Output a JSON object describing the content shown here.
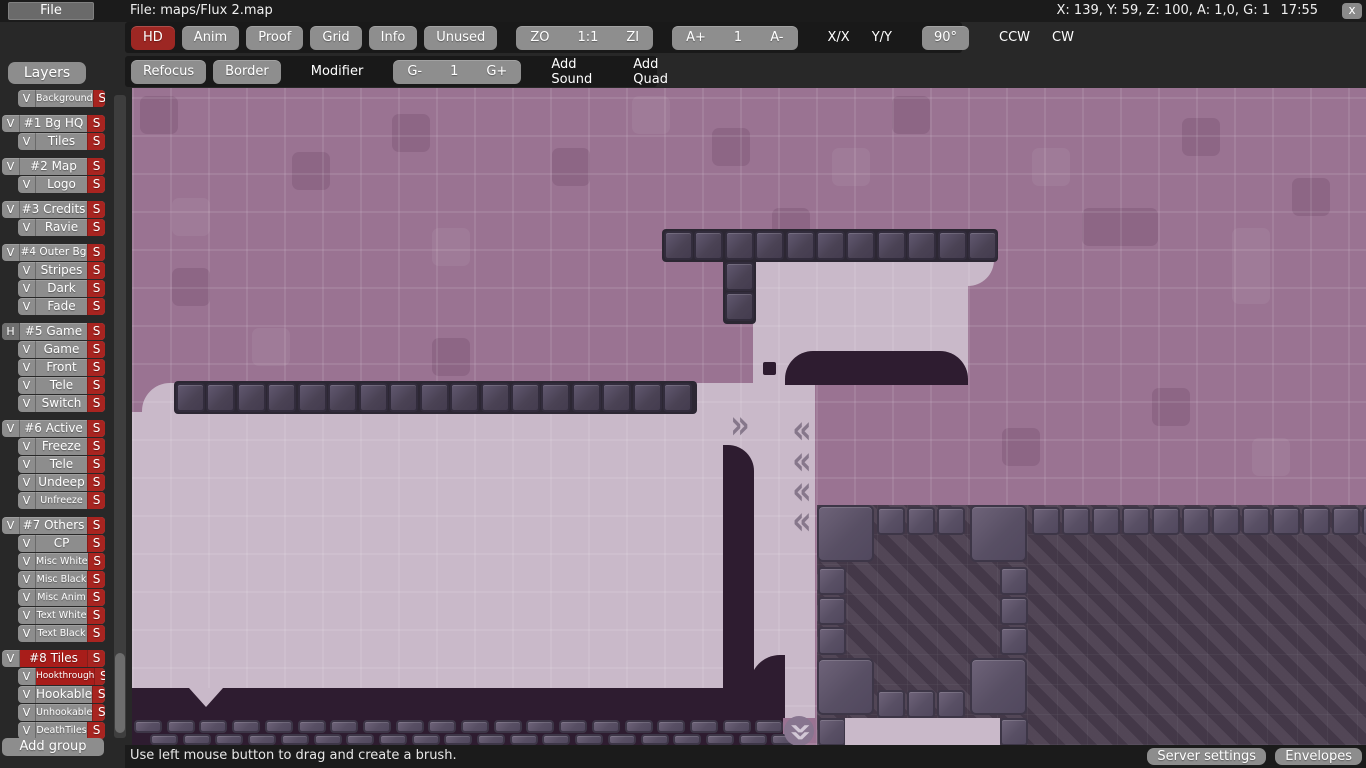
{
  "topbar": {
    "file_menu": "File",
    "title": "File: maps/Flux 2.map",
    "info": "X: 139, Y: 59, Z: 100, A: 1,0, G: 1",
    "time": "17:55",
    "close_glyph": "x"
  },
  "toolbar": {
    "row1": [
      {
        "t": "btn",
        "label": "HD",
        "style": "red"
      },
      {
        "t": "btn",
        "label": "Anim"
      },
      {
        "t": "btn",
        "label": "Proof"
      },
      {
        "t": "btn",
        "label": "Grid"
      },
      {
        "t": "btn",
        "label": "Info"
      },
      {
        "t": "btn",
        "label": "Unused"
      },
      {
        "t": "seg",
        "labels": [
          "ZO",
          "1:1",
          "ZI"
        ],
        "gap": true
      },
      {
        "t": "seg",
        "labels": [
          "A+",
          "1",
          "A-"
        ],
        "gap": true
      },
      {
        "t": "plain",
        "labels": [
          "X/X",
          "Y/Y"
        ],
        "gap": true
      },
      {
        "t": "btn",
        "label": "90°",
        "gap": true
      },
      {
        "t": "plain",
        "labels": [
          "CCW",
          "CW"
        ],
        "gap": true
      }
    ],
    "row2": [
      {
        "t": "btn",
        "label": "Refocus"
      },
      {
        "t": "btn",
        "label": "Border"
      },
      {
        "t": "plain",
        "labels": [
          "Modifier"
        ],
        "gap": true
      },
      {
        "t": "seg",
        "labels": [
          "G-",
          "1",
          "G+"
        ],
        "gap": true
      },
      {
        "t": "plain",
        "labels": [
          "Add Sound"
        ],
        "gap": true
      },
      {
        "t": "plain",
        "labels": [
          "Add Quad"
        ],
        "gap": true
      }
    ]
  },
  "layers": {
    "header": "Layers",
    "add_group": "Add group",
    "detail_label": "S",
    "items": [
      {
        "label": "Background",
        "kind": "layer",
        "vis": "V",
        "fs": 9.5
      },
      {
        "label": "#1 Bg HQ",
        "kind": "group",
        "vis": "V"
      },
      {
        "label": "Tiles",
        "kind": "layer",
        "vis": "V"
      },
      {
        "label": "#2 Map",
        "kind": "group",
        "vis": "V"
      },
      {
        "label": "Logo",
        "kind": "layer",
        "vis": "V"
      },
      {
        "label": "#3 Credits",
        "kind": "group",
        "vis": "V"
      },
      {
        "label": "Ravie",
        "kind": "layer",
        "vis": "V"
      },
      {
        "label": "#4 Outer Bg",
        "kind": "group",
        "vis": "V",
        "fs": 10.5
      },
      {
        "label": "Stripes",
        "kind": "layer",
        "vis": "V"
      },
      {
        "label": "Dark",
        "kind": "layer",
        "vis": "V"
      },
      {
        "label": "Fade",
        "kind": "layer",
        "vis": "V"
      },
      {
        "label": "#5 Game",
        "kind": "group",
        "vis": "H"
      },
      {
        "label": "Game",
        "kind": "layer",
        "vis": "V"
      },
      {
        "label": "Front",
        "kind": "layer",
        "vis": "V"
      },
      {
        "label": "Tele",
        "kind": "layer",
        "vis": "V"
      },
      {
        "label": "Switch",
        "kind": "layer",
        "vis": "V"
      },
      {
        "label": "#6 Active",
        "kind": "group",
        "vis": "V"
      },
      {
        "label": "Freeze",
        "kind": "layer",
        "vis": "V"
      },
      {
        "label": "Tele",
        "kind": "layer",
        "vis": "V"
      },
      {
        "label": "Undeep",
        "kind": "layer",
        "vis": "V"
      },
      {
        "label": "Unfreeze",
        "kind": "layer",
        "vis": "V",
        "fs": 9.5
      },
      {
        "label": "#7 Others",
        "kind": "group",
        "vis": "V"
      },
      {
        "label": "CP",
        "kind": "layer",
        "vis": "V"
      },
      {
        "label": "Misc White",
        "kind": "layer",
        "vis": "V",
        "fs": 9.5
      },
      {
        "label": "Misc Black",
        "kind": "layer",
        "vis": "V",
        "fs": 9.5
      },
      {
        "label": "Misc Anim",
        "kind": "layer",
        "vis": "V",
        "fs": 9.5
      },
      {
        "label": "Text White",
        "kind": "layer",
        "vis": "V",
        "fs": 9.5
      },
      {
        "label": "Text Black",
        "kind": "layer",
        "vis": "V",
        "fs": 9.5
      },
      {
        "label": "#8 Tiles",
        "kind": "group",
        "vis": "V",
        "sel": true
      },
      {
        "label": "Hookthrough",
        "kind": "layer",
        "vis": "V",
        "sel": true,
        "fs": 9
      },
      {
        "label": "Hookable",
        "kind": "layer",
        "vis": "V"
      },
      {
        "label": "Unhookable",
        "kind": "layer",
        "vis": "V",
        "fs": 9.5
      },
      {
        "label": "DeathTiles",
        "kind": "layer",
        "vis": "V",
        "fs": 9.5
      }
    ]
  },
  "statusbar": {
    "hint": "Use left mouse button to drag and create a brush.",
    "buttons": [
      "Server settings",
      "Envelopes"
    ]
  },
  "colors": {
    "accent_red": "#9d2723",
    "selected_red": "#a81d1a",
    "detail_red": "#a82420",
    "button_gray": "#8e8e8e",
    "canvas_purple": "#9a7392",
    "map_light": "#c9b9c9",
    "map_dark": "#2e1c30"
  },
  "canvas": {
    "chevron_glyphs": {
      "right": "»",
      "left": "«"
    },
    "patches": [
      [
        8,
        8,
        38,
        38,
        "d"
      ],
      [
        160,
        64,
        38,
        38,
        "d"
      ],
      [
        260,
        26,
        38,
        38,
        "d"
      ],
      [
        300,
        140,
        38,
        38,
        "l"
      ],
      [
        420,
        60,
        38,
        38,
        "d"
      ],
      [
        500,
        8,
        38,
        38,
        "l"
      ],
      [
        580,
        40,
        38,
        38,
        "d"
      ],
      [
        700,
        60,
        38,
        38,
        "l"
      ],
      [
        760,
        8,
        38,
        38,
        "d"
      ],
      [
        900,
        60,
        38,
        38,
        "l"
      ],
      [
        950,
        120,
        76,
        38,
        "d"
      ],
      [
        1050,
        30,
        38,
        38,
        "d"
      ],
      [
        1100,
        140,
        38,
        76,
        "l"
      ],
      [
        1160,
        90,
        38,
        38,
        "d"
      ],
      [
        40,
        180,
        38,
        38,
        "d"
      ],
      [
        120,
        240,
        38,
        38,
        "l"
      ],
      [
        300,
        250,
        38,
        38,
        "d"
      ],
      [
        1020,
        300,
        38,
        38,
        "d"
      ],
      [
        1120,
        350,
        38,
        38,
        "l"
      ],
      [
        870,
        340,
        38,
        38,
        "d"
      ],
      [
        40,
        110,
        38,
        38,
        "l"
      ],
      [
        640,
        120,
        38,
        38,
        "d"
      ]
    ],
    "lights": [
      [
        621,
        172,
        215,
        125,
        ""
      ],
      [
        836,
        172,
        26,
        26,
        "0 0 26px 0"
      ],
      [
        562,
        295,
        121,
        30,
        ""
      ],
      [
        10,
        295,
        34,
        30,
        "28px 0 0 0"
      ],
      [
        0,
        324,
        683,
        277,
        ""
      ],
      [
        653,
        600,
        30,
        30,
        ""
      ]
    ],
    "darks": [
      [
        653,
        263,
        183,
        34,
        "28px 28px 0 0"
      ],
      [
        631,
        274,
        13,
        13,
        "2px"
      ],
      [
        591,
        357,
        31,
        244,
        "0 26px 0 0"
      ],
      [
        618,
        567,
        35,
        34,
        "30px 0 0 0"
      ],
      [
        0,
        600,
        653,
        30,
        ""
      ],
      [
        0,
        630,
        651,
        27,
        ""
      ]
    ],
    "notch": [
      57,
      600
    ],
    "beds": [
      [
        530,
        141,
        336,
        33
      ],
      [
        591,
        141,
        33,
        95
      ],
      [
        42,
        293,
        523,
        33
      ]
    ],
    "unhook_rows": [
      {
        "x": 532,
        "y": 143,
        "n": 11,
        "s": 29,
        "step": 30.4
      },
      {
        "x": 593,
        "y": 174,
        "n": 1,
        "s": 29,
        "step": 30.4
      },
      {
        "x": 593,
        "y": 204,
        "n": 1,
        "s": 29,
        "step": 30.4
      },
      {
        "x": 44,
        "y": 295,
        "n": 17,
        "s": 29,
        "step": 30.45
      }
    ],
    "structure": {
      "striped": [
        685,
        417,
        549,
        240
      ],
      "big_tiles": [
        [
          685,
          417
        ],
        [
          838,
          417
        ],
        [
          685,
          570
        ],
        [
          838,
          570
        ]
      ],
      "small_tiles": [
        [
          745,
          419
        ],
        [
          775,
          419
        ],
        [
          805,
          419
        ],
        [
          686,
          479
        ],
        [
          686,
          509
        ],
        [
          686,
          539
        ],
        [
          868,
          479
        ],
        [
          868,
          509
        ],
        [
          868,
          539
        ],
        [
          745,
          602
        ],
        [
          775,
          602
        ],
        [
          805,
          602
        ],
        [
          686,
          630
        ],
        [
          868,
          630
        ]
      ],
      "top_row": {
        "x": 900,
        "y": 419,
        "n": 12,
        "step": 30
      },
      "bottom_light": [
        713,
        630,
        155,
        27
      ]
    },
    "bottom_row": {
      "x": 0,
      "y": 630,
      "n": 20,
      "step": 32.7
    },
    "chevrons": [
      {
        "x": 592,
        "y": 322,
        "d": "r"
      },
      {
        "x": 654,
        "y": 327,
        "d": "l"
      },
      {
        "x": 654,
        "y": 358,
        "d": "l"
      },
      {
        "x": 654,
        "y": 388,
        "d": "l"
      },
      {
        "x": 654,
        "y": 418,
        "d": "l"
      },
      {
        "x": 652,
        "y": 628,
        "d": "down",
        "disc": true
      }
    ]
  }
}
